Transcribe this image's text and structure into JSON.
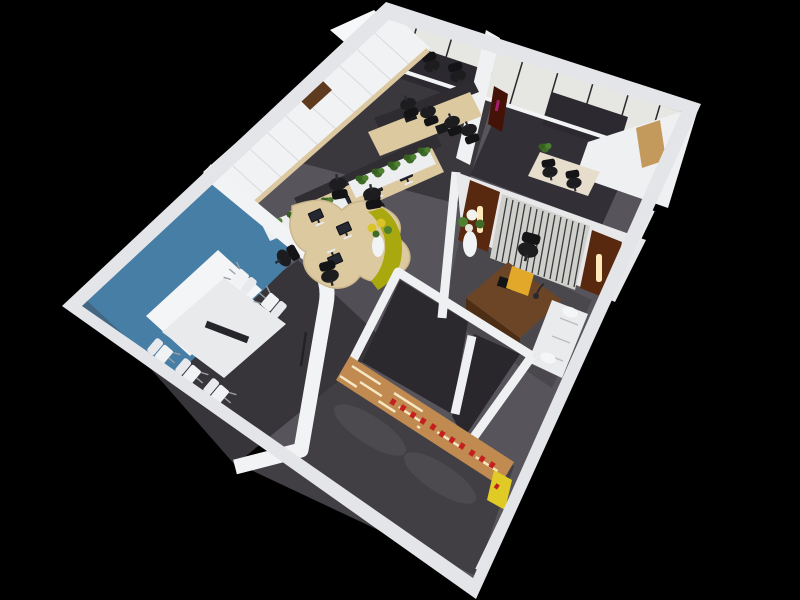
{
  "scene": {
    "kind": "3d-floorplan-render",
    "description": "Aerial isometric cutaway 3D rendering of a small office interior on a solid black background, rotated diamond orientation",
    "background": "#000000"
  },
  "palette": {
    "background": "#000000",
    "rim": "#e4e5e8",
    "wall_white": "#f1f2f4",
    "wall_shade": "#dddee2",
    "carpet_base": "#57555b",
    "carpet_work": "#3a383d",
    "carpet_room_dark": "#323036",
    "carpet_meeting": "#37353a",
    "carpet_reception": "#423f44",
    "carpet_storage": "#2b292e",
    "accent_blue": "#467ea6",
    "accent_olive": "#a9a90f",
    "accent_yellow": "#e2a82a",
    "accent_sign_yellow": "#e0ca25",
    "wood_light": "#dcc9a0",
    "wood_medium": "#c08a50",
    "wood_dark": "#6b4526",
    "door_maroon": "#58290f",
    "signage_red": "#c42020",
    "plant_green": "#3e6b28",
    "chair_black": "#1d1d20",
    "furniture_white": "#eef0f2",
    "blind_grey": "#e6e6e2",
    "glass_dark": "#2c2a30"
  },
  "rooms": [
    {
      "id": "meeting-room",
      "label": "meeting room",
      "features": [
        "blue accent wall",
        "white projection screen",
        "white conference table with dark center runner"
      ],
      "white_chairs_visible": 5
    },
    {
      "id": "open-office",
      "label": "open plan office",
      "features": [
        "white cabinet wall with wood niche",
        "two straight desk rows with monitors",
        "curved 4-seat desk cluster",
        "olive curved divider",
        "white planter boxes",
        "flower vase"
      ],
      "monitors_visible": 7,
      "black_chairs_visible": 9,
      "planter_boxes": 3
    },
    {
      "id": "window-office",
      "label": "corner window office",
      "features": [
        "floor-to-ceiling blinds",
        "small desk",
        "desk plant"
      ],
      "dark_chairs_visible": 2
    },
    {
      "id": "executive-office",
      "label": "executive office",
      "features": [
        "two dark wood door panels with lit sconces",
        "metal slat screen wall",
        "dark wood desk",
        "yellow accent chair",
        "desk lamp",
        "white flower vase",
        "white sofa"
      ],
      "sconces": 2
    },
    {
      "id": "reception",
      "label": "reception hall",
      "features": [
        "large dark carpet",
        "wood feature wall with backlit strips",
        "row of red signage glyphs",
        "yellow end sign",
        "two storage rooms behind feature wall"
      ],
      "signage_glyphs": 11,
      "backlit_strips": 3
    }
  ]
}
